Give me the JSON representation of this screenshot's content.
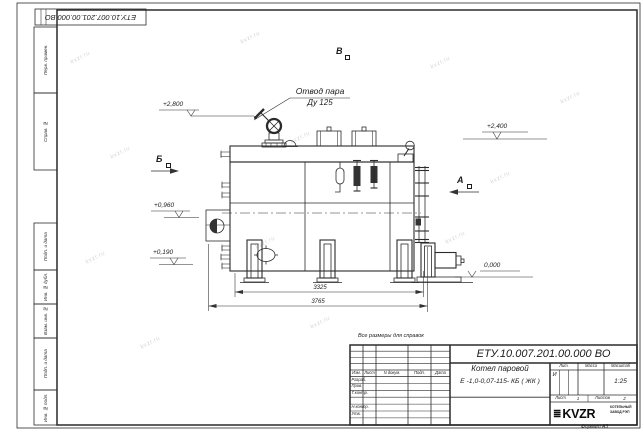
{
  "page": {
    "corner_designation": "ЕТУ.10.007.201.00.000  ВО",
    "reference_note": "Все размеры для справок",
    "format_label": "Формат А3",
    "watermark": "kvzr.ru"
  },
  "margin_columns": {
    "perv_primen": "Перв. примен.",
    "sprav_no": "Справ. №",
    "podp_data_1": "Подп. и дата",
    "inv_dubl": "Инв. № дубл.",
    "vzam_inv": "Взам. инв. №",
    "podp_data_2": "Подп. и дата",
    "inv_podl": "Инв. № подл."
  },
  "drawing": {
    "callout": {
      "line1": "Отвод пара",
      "line2": "Ду 125"
    },
    "views": {
      "top": "В",
      "left": "Б",
      "right": "А"
    },
    "elevations": {
      "valve": "+2,800",
      "right": "+2,400",
      "burner": "+0,960",
      "lower": "+0,190",
      "ground": "0,000"
    },
    "dimensions": {
      "inner": "3325",
      "overall": "3765"
    }
  },
  "title_block": {
    "designation": "ЕТУ.10.007.201.00.000  ВО",
    "product_line1": "Котел паровой",
    "product_line2": "Е -1,0-0,07-115- КБ ( ЖК )",
    "header": {
      "izm": "Изм.",
      "list": "Лист",
      "ndoc": "N докум.",
      "podp": "Подп.",
      "date": "Дата"
    },
    "staff": {
      "razrab": "Разраб.",
      "prov": "Пров.",
      "tkontr": "Т.контр.",
      "nkontr": "Н.контр.",
      "utv": "Утв."
    },
    "lit_label": "Лит.",
    "mass_label": "Масса",
    "scale_label": "Масштаб",
    "lit_value": "И",
    "scale_value": "1:25",
    "sheet_label": "Лист",
    "sheet_value": "1",
    "sheets_label": "Листов",
    "sheets_value": "2",
    "logo_icon": "≣",
    "logo": "KVZR",
    "company_line1": "КОТЕЛЬНЫЙ",
    "company_line2": "ЗАВОД РЭП"
  }
}
